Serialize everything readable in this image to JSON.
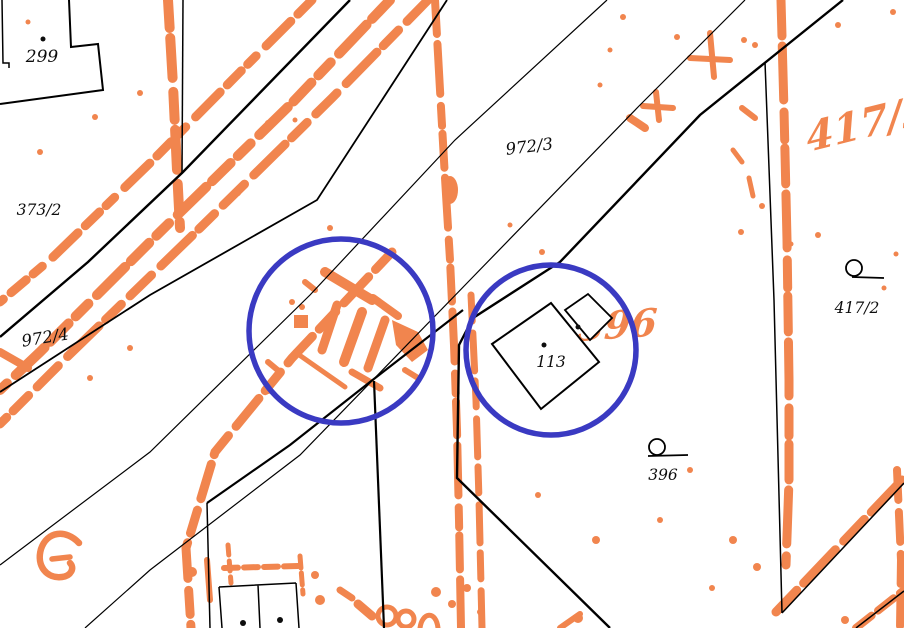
{
  "map": {
    "title": "cadastral-map-view",
    "colors": {
      "raster_orange": "#F1854E",
      "line_black": "#000000",
      "highlight_blue": "#3A3AC2",
      "background": "#FFFFFF"
    },
    "parcel_labels": [
      {
        "id": "299",
        "text": "299",
        "x": 42,
        "y": 62,
        "rotate": 0,
        "size": 17
      },
      {
        "id": "373-2",
        "text": "373/2",
        "x": 39,
        "y": 215,
        "rotate": 0,
        "size": 15.5
      },
      {
        "id": "972-3",
        "text": "972/3",
        "x": 530,
        "y": 152,
        "rotate": -7,
        "size": 16.5
      },
      {
        "id": "972-4",
        "text": "972/4",
        "x": 46,
        "y": 343,
        "rotate": -9,
        "size": 16.5
      },
      {
        "id": "113",
        "text": "113",
        "x": 551,
        "y": 367,
        "rotate": 0,
        "size": 15.5
      },
      {
        "id": "396",
        "text": "396",
        "x": 663,
        "y": 480,
        "rotate": 0,
        "size": 15.5
      },
      {
        "id": "417-2",
        "text": "417/2",
        "x": 857,
        "y": 313,
        "rotate": 0,
        "size": 15.5
      }
    ],
    "raster_annotations": [
      {
        "id": "orange-417-2",
        "text": "417/2",
        "x": 808,
        "y": 152,
        "rotate": -14,
        "size": 40
      },
      {
        "id": "orange-396",
        "text": "396",
        "x": 577,
        "y": 341,
        "rotate": -4,
        "size": 38
      }
    ],
    "highlight_circles": [
      {
        "id": "highlight-circle-left",
        "cx": 341,
        "cy": 331,
        "r": 92
      },
      {
        "id": "highlight-circle-right",
        "cx": 551,
        "cy": 350,
        "r": 85
      }
    ],
    "symbols": [
      {
        "name": "loop-landuse-symbol",
        "near_parcel": "417/2"
      },
      {
        "name": "loop-landuse-symbol",
        "near_parcel": "396"
      }
    ]
  }
}
